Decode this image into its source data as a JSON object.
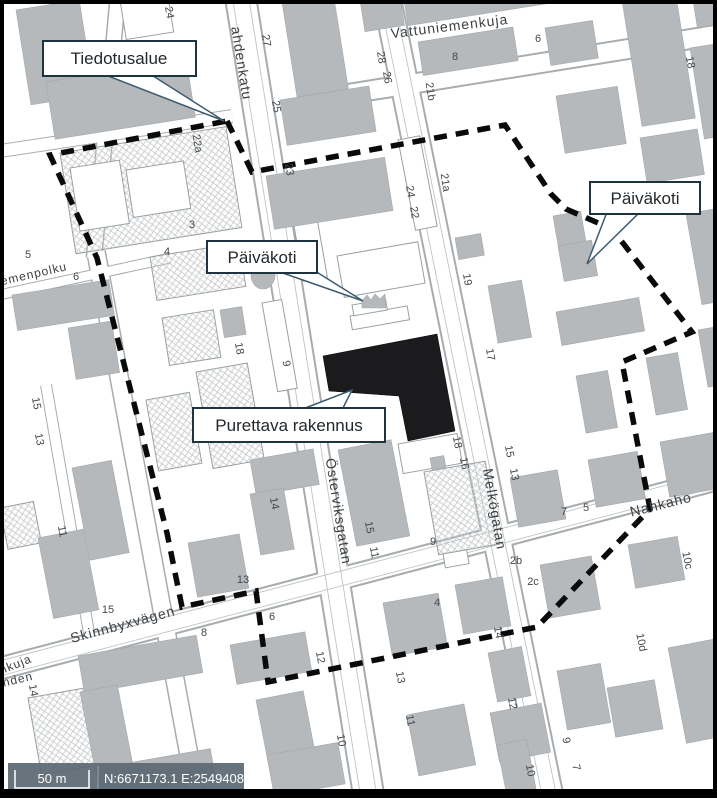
{
  "map": {
    "street_labels": [
      {
        "t": "ahdenkatu",
        "x": 237,
        "y": 64,
        "r": 81,
        "size": 14
      },
      {
        "t": "Vattuniemenkuja",
        "x": 450,
        "y": 31,
        "r": -7,
        "size": 14
      },
      {
        "t": "Österviksgatan",
        "x": 334,
        "y": 512,
        "r": 81,
        "size": 14
      },
      {
        "t": "Melkögatan",
        "x": 490,
        "y": 510,
        "r": 80,
        "size": 14
      },
      {
        "t": "Skinnbyxvägen",
        "x": 124,
        "y": 629,
        "r": -15,
        "size": 14
      },
      {
        "t": "Nahkaho",
        "x": 662,
        "y": 509,
        "r": -14,
        "size": 14
      },
      {
        "t": "iemenpolku",
        "x": 33,
        "y": 278,
        "r": -13,
        "size": 12
      },
      {
        "t": "nkuja",
        "x": 17,
        "y": 668,
        "r": -22,
        "size": 12
      },
      {
        "t": "änden",
        "x": 15,
        "y": 684,
        "r": -13,
        "size": 12
      }
    ],
    "house_numbers": [
      {
        "t": "24",
        "x": 166,
        "y": 13,
        "r": 81
      },
      {
        "t": "27",
        "x": 263,
        "y": 41,
        "r": 81
      },
      {
        "t": "25",
        "x": 273,
        "y": 107,
        "r": 81
      },
      {
        "t": "23",
        "x": 286,
        "y": 170,
        "r": 81
      },
      {
        "t": "22a",
        "x": 194,
        "y": 144,
        "r": 81
      },
      {
        "t": "3",
        "x": 192,
        "y": 228,
        "r": 0
      },
      {
        "t": "4",
        "x": 167,
        "y": 255,
        "r": 0
      },
      {
        "t": "5",
        "x": 28,
        "y": 258,
        "r": 0
      },
      {
        "t": "6",
        "x": 76,
        "y": 280,
        "r": 0
      },
      {
        "t": "28",
        "x": 378,
        "y": 58,
        "r": 81
      },
      {
        "t": "26",
        "x": 384,
        "y": 78,
        "r": 81
      },
      {
        "t": "8",
        "x": 455,
        "y": 60,
        "r": 0
      },
      {
        "t": "6",
        "x": 538,
        "y": 42,
        "r": 0
      },
      {
        "t": "18",
        "x": 687,
        "y": 63,
        "r": 79
      },
      {
        "t": "21b",
        "x": 427,
        "y": 92,
        "r": 81
      },
      {
        "t": "21a",
        "x": 442,
        "y": 183,
        "r": 81
      },
      {
        "t": "24",
        "x": 407,
        "y": 192,
        "r": 81
      },
      {
        "t": "22",
        "x": 411,
        "y": 213,
        "r": 81
      },
      {
        "t": "19",
        "x": 464,
        "y": 280,
        "r": 81
      },
      {
        "t": "17",
        "x": 487,
        "y": 355,
        "r": 81
      },
      {
        "t": "18",
        "x": 236,
        "y": 349,
        "r": 81
      },
      {
        "t": "9",
        "x": 283,
        "y": 364,
        "r": 81
      },
      {
        "t": "15",
        "x": 33,
        "y": 404,
        "r": 79
      },
      {
        "t": "13",
        "x": 36,
        "y": 440,
        "r": 79
      },
      {
        "t": "11",
        "x": 59,
        "y": 532,
        "r": 79
      },
      {
        "t": "18",
        "x": 454,
        "y": 443,
        "r": 79
      },
      {
        "t": "16",
        "x": 461,
        "y": 464,
        "r": 79
      },
      {
        "t": "15",
        "x": 506,
        "y": 452,
        "r": 79
      },
      {
        "t": "13",
        "x": 511,
        "y": 475,
        "r": 79
      },
      {
        "t": "9",
        "x": 433,
        "y": 545,
        "r": 0
      },
      {
        "t": "15",
        "x": 366,
        "y": 528,
        "r": 79
      },
      {
        "t": "11",
        "x": 371,
        "y": 553,
        "r": 79
      },
      {
        "t": "14",
        "x": 271,
        "y": 504,
        "r": 79
      },
      {
        "t": "13",
        "x": 243,
        "y": 583,
        "r": 0
      },
      {
        "t": "15",
        "x": 108,
        "y": 613,
        "r": 0
      },
      {
        "t": "8",
        "x": 204,
        "y": 636,
        "r": 0
      },
      {
        "t": "7",
        "x": 564,
        "y": 515,
        "r": 0
      },
      {
        "t": "5",
        "x": 586,
        "y": 511,
        "r": 0
      },
      {
        "t": "2c",
        "x": 533,
        "y": 585,
        "r": 0
      },
      {
        "t": "2b",
        "x": 516,
        "y": 564,
        "r": 0
      },
      {
        "t": "10c",
        "x": 684,
        "y": 561,
        "r": 79
      },
      {
        "t": "10d",
        "x": 638,
        "y": 643,
        "r": 79
      },
      {
        "t": "4",
        "x": 437,
        "y": 606,
        "r": 0
      },
      {
        "t": "6",
        "x": 272,
        "y": 620,
        "r": 0
      },
      {
        "t": "12",
        "x": 317,
        "y": 658,
        "r": 79
      },
      {
        "t": "13",
        "x": 397,
        "y": 678,
        "r": 79
      },
      {
        "t": "11",
        "x": 407,
        "y": 721,
        "r": 79
      },
      {
        "t": "10",
        "x": 338,
        "y": 741,
        "r": 79
      },
      {
        "t": "14",
        "x": 495,
        "y": 633,
        "r": 79
      },
      {
        "t": "12",
        "x": 509,
        "y": 704,
        "r": 79
      },
      {
        "t": "9",
        "x": 563,
        "y": 741,
        "r": 79
      },
      {
        "t": "10",
        "x": 527,
        "y": 771,
        "r": 79
      },
      {
        "t": "7",
        "x": 573,
        "y": 768,
        "r": 79
      },
      {
        "t": "14",
        "x": 30,
        "y": 691,
        "r": 79
      }
    ],
    "callouts": [
      {
        "id": "tiedotusalue",
        "label": "Tiedotusalue"
      },
      {
        "id": "paivakoti-center",
        "label": "Päiväkoti"
      },
      {
        "id": "purettava-rakennus",
        "label": "Purettava rakennus"
      },
      {
        "id": "paivakoti-right",
        "label": "Päiväkoti"
      }
    ],
    "scalebar": {
      "distance_label": "50 m",
      "coordinates": "N:6671173.1 E:25494082.0"
    },
    "colors": {
      "building": "#b6b9bb",
      "demolish": "#1b1b1d",
      "boundary": "#0a0a0a",
      "callout-border": "#1e3340",
      "callout-leader": "#3e5c70",
      "road-edge": "#a8acaf",
      "hatch-line": "#c6c9cb",
      "label-text": "#45484b",
      "scalebar-bg": "#5b6872",
      "scalebar-text": "#ffffff"
    }
  }
}
